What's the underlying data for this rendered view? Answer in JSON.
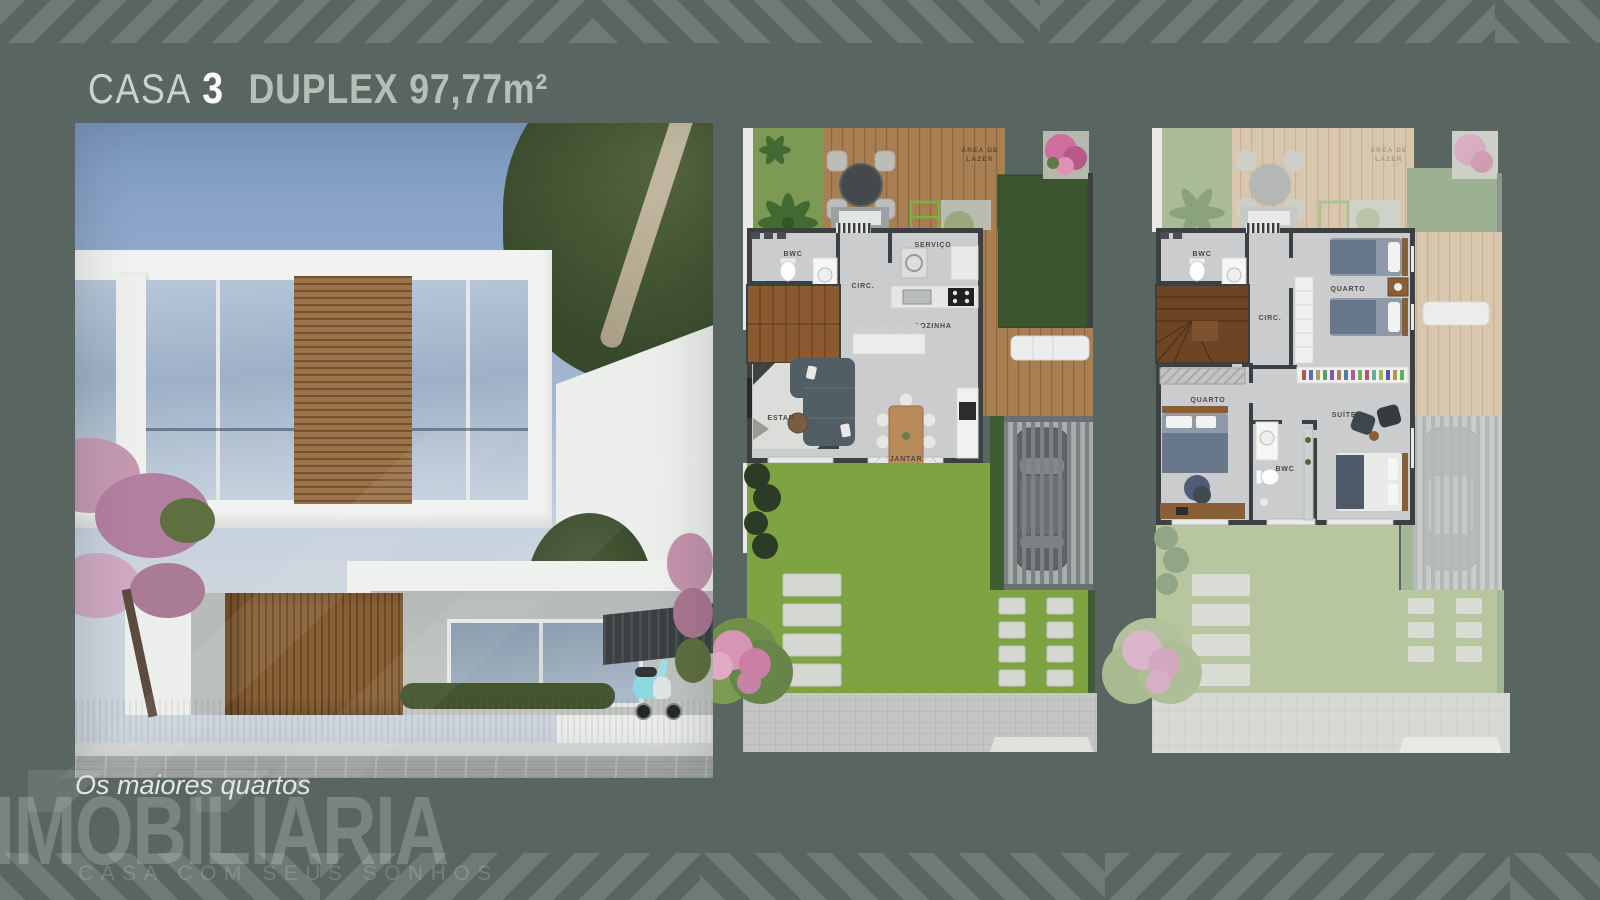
{
  "page": {
    "background": "#596560",
    "stripe_color": "#6e7a73"
  },
  "title": {
    "prefix": "CASA",
    "number": "3",
    "spec": "DUPLEX 97,77m²"
  },
  "caption": "Os maiores quartos",
  "watermark": {
    "brand": "IMOBILIÁRIA",
    "tagline": "CASA COM SEUS SONHOS"
  },
  "plans": {
    "ground": {
      "area_label": [
        "ÁREA DE",
        "LAZER"
      ],
      "rooms": {
        "bwc": "BWC",
        "servico": "SERVIÇO",
        "circ": "CIRC.",
        "cozinha": "COZINHA",
        "estar": "ESTAR",
        "jantar": "JANTAR"
      }
    },
    "upper": {
      "area_label": [
        "ÁREA DE",
        "LAZER"
      ],
      "rooms": {
        "bwc": "BWC",
        "circ": "CIRC.",
        "quarto_twin": "QUARTO",
        "quarto": "QUARTO",
        "bwc2": "BWC",
        "suite": "SUÍTE"
      }
    }
  }
}
